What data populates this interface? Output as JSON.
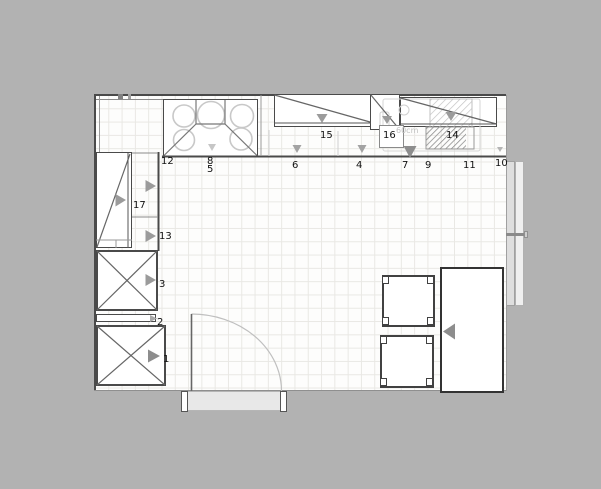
{
  "plan": {
    "title": "kitchen-floor-plan",
    "labels": {
      "n1": "1",
      "n2": "2",
      "n3": "3",
      "n4": "4",
      "n5": "5",
      "n6": "6",
      "n7": "7",
      "n8": "8",
      "n9": "9",
      "n10": "10",
      "n11": "11",
      "n12": "12",
      "n13": "13",
      "n14": "14",
      "n15": "15",
      "n16": "16",
      "n17": "17",
      "dim": "60cm"
    },
    "colors": {
      "background": "#b2b2b2",
      "floor": "#fdfdfc",
      "grid": "#e9e8e4",
      "wall": "#4a4a4a",
      "line-light": "#9a9a9a",
      "arrow": "#9b9b9b",
      "arrow-dark": "#8d8d8d",
      "hatch-dark": "#8f8f8f",
      "hatch-light": "#c4c4c4",
      "label": "#111111"
    }
  }
}
